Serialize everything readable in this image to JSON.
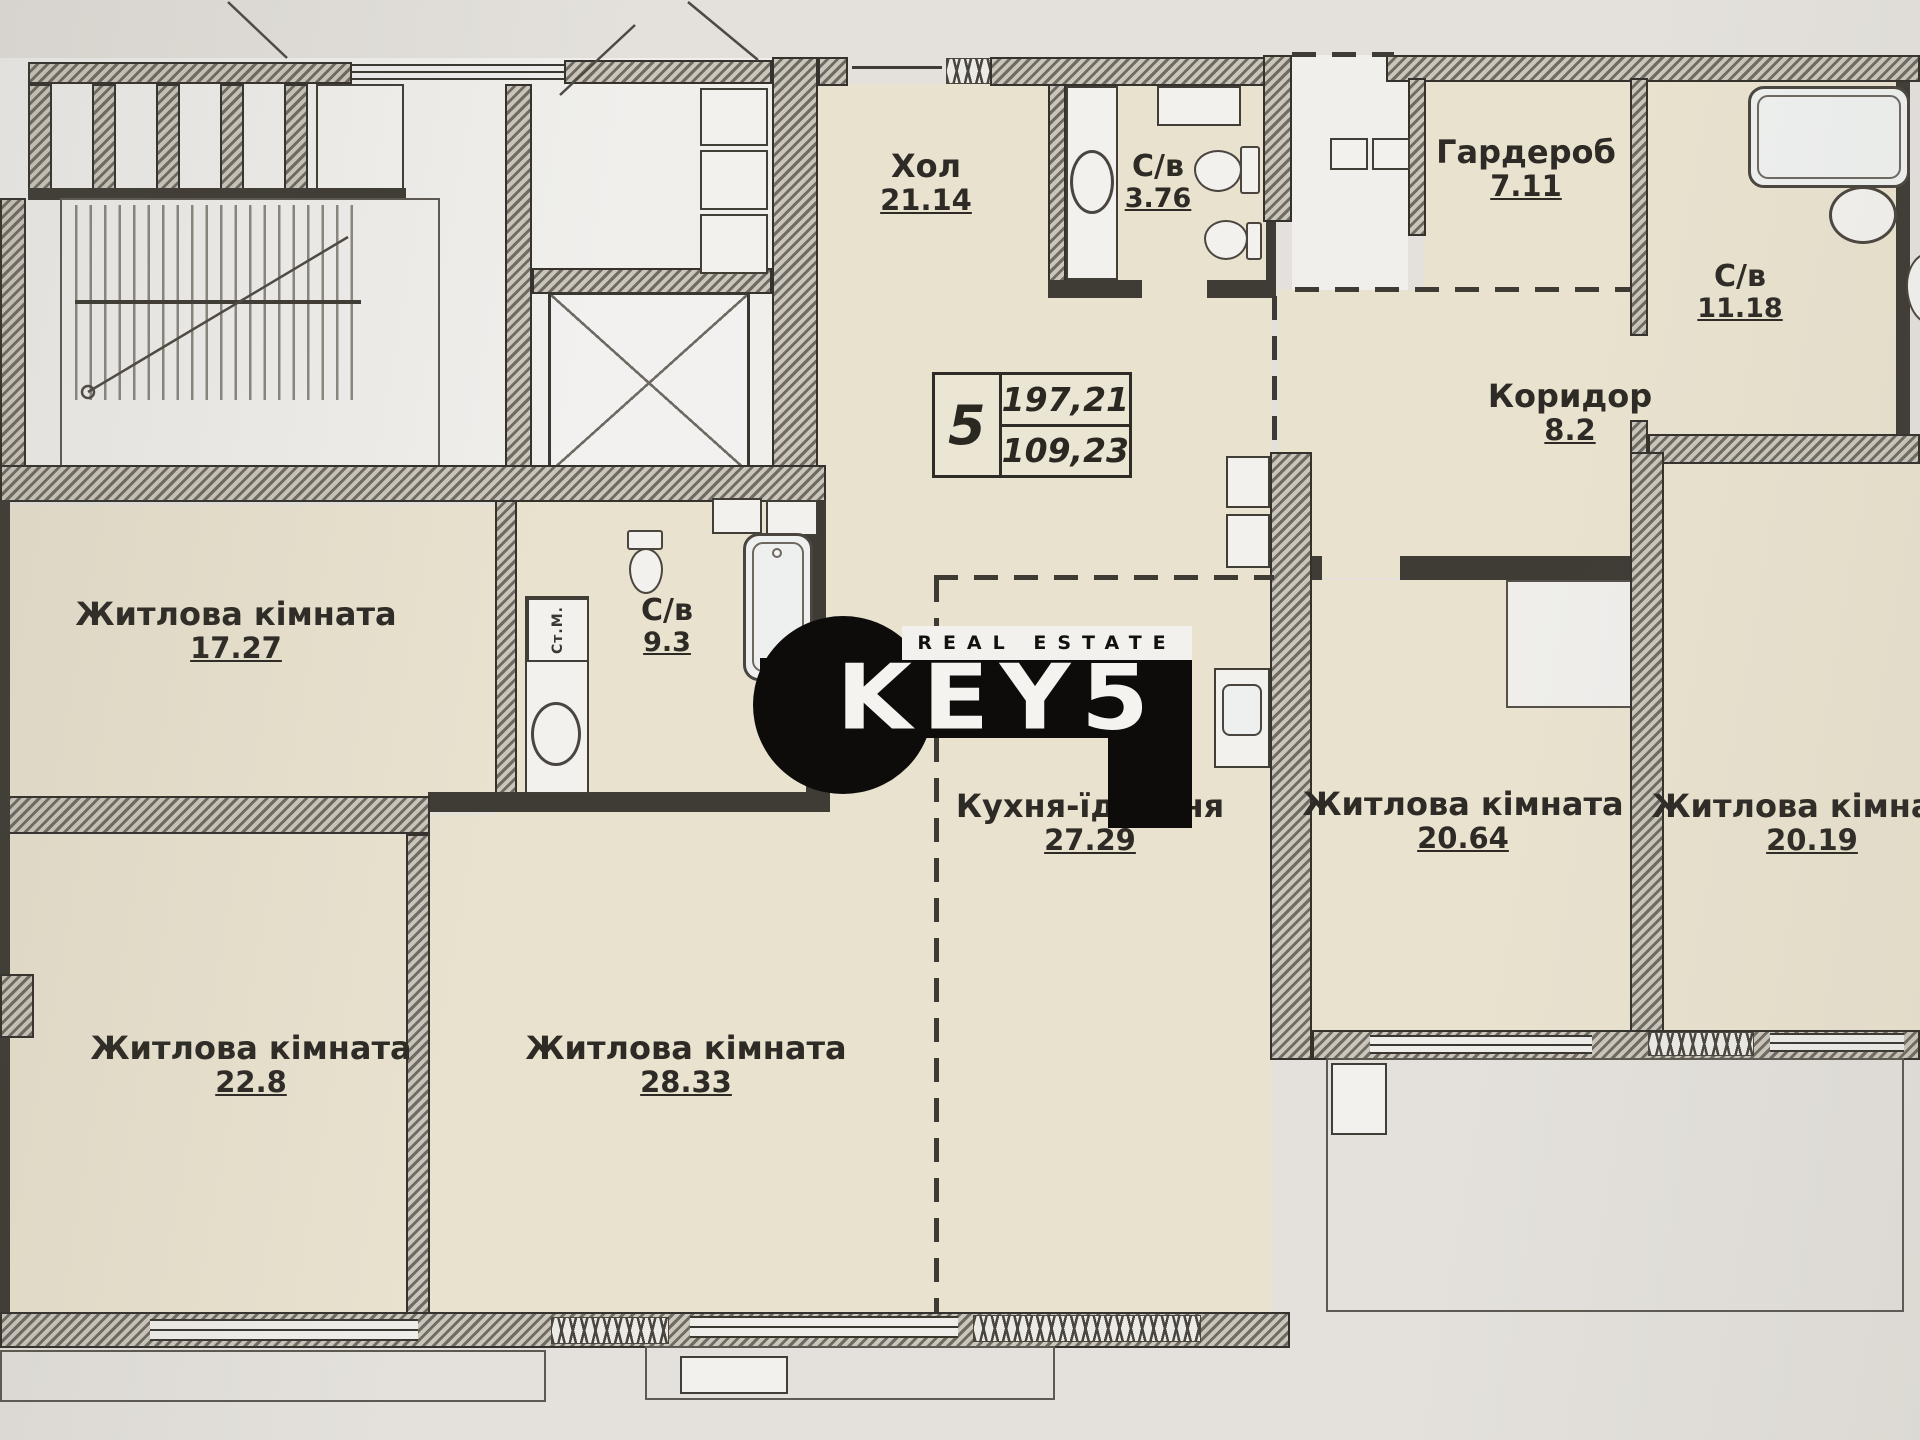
{
  "plan": {
    "unit_box": {
      "number": "5",
      "area_total": "197,21",
      "area_living": "109,23"
    },
    "rooms": [
      {
        "name": "Хол",
        "area": "21.14"
      },
      {
        "name": "С/в",
        "area": "3.76"
      },
      {
        "name": "Гардероб",
        "area": "7.11"
      },
      {
        "name": "С/в",
        "area": "11.18"
      },
      {
        "name": "Коридор",
        "area": "8.2"
      },
      {
        "name": "Житлова кімната",
        "area": "17.27"
      },
      {
        "name": "С/в",
        "area": "9.3"
      },
      {
        "name": "Кухня-їдальня",
        "area": "27.29"
      },
      {
        "name": "Житлова кімната",
        "area": "20.64"
      },
      {
        "name": "Житлова кімната",
        "area": "20.19"
      },
      {
        "name": "Житлова кімната",
        "area": "22.8"
      },
      {
        "name": "Житлова кімната",
        "area": "28.33"
      }
    ],
    "fixtures": {
      "washer_label": "Ст.М."
    },
    "logo": {
      "tagline": "REAL ESTATE",
      "brand": "KEYS",
      "display": "KEY5"
    },
    "colors": {
      "room_fill": "#e9e2cf",
      "wall_dark": "#3f3b35",
      "paper": "#e4e1dc",
      "logo_black": "#0d0c0b"
    }
  }
}
